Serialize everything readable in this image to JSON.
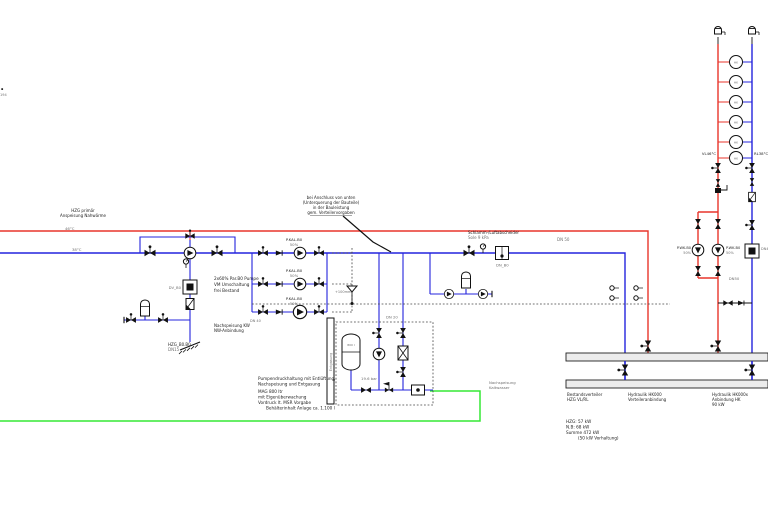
{
  "colors": {
    "supply_red": "#e8352b",
    "return_blue": "#2424dd",
    "fill_green": "#35e835",
    "line_black": "#111111",
    "header_fill": "#ececec",
    "text_gray": "#707070"
  },
  "labels": {
    "margin": {
      "l1": "▪",
      "l2": "194"
    },
    "feed": {
      "line1": "HZG primär",
      "line2": "Anspeisung Nahwärme",
      "vl": "46°C",
      "rl": "38°C"
    },
    "callout": {
      "l1": "bei Anschluss von unten",
      "l2": "(Unterquerung der Bauteile)",
      "l3": "in der Bauleistung",
      "l4": "gem. Verteilervorgaben"
    },
    "mixer": {
      "note1": "2x60% Par.B0 Pumpe",
      "note2": "VM Umschaltung",
      "note3": "frei Bestand",
      "dv": "DV_B0",
      "refill1": "Nachspeisung KW",
      "refill2": "NW-Anbindung",
      "tag1": "HZG_B0.B0",
      "tag2": "DN15"
    },
    "pumps": {
      "name": "P.KAL.B0",
      "pct": "50%"
    },
    "separator": {
      "l1": "Schlamm-/Luftabscheider",
      "l2": "Sole 9 kPa",
      "dn": "DN_B0"
    },
    "line": {
      "dn50": "DN 50",
      "plus": "+100mm",
      "dn40": "DN 40"
    },
    "unit": {
      "dn20": "DN 20",
      "vessel": "800 l",
      "bar": "19.6 bar",
      "column": "Entgasung",
      "n1": "Pumpendruckhaltung mit Entlüftung,",
      "n2": "Nachspeisung und Entgasung",
      "n3": "MAG 800 ltr",
      "n4": "mit Eigenüberwachung",
      "n5": "Vordruck lt. MSR Vorgabe",
      "n6": "Behälterinhalt Anlage ca. 1.100 l",
      "green1": "Nachspeisung",
      "green2": "Kaltwasser"
    },
    "headers": {
      "a1": "Bestandsverteiler",
      "a2": "HZG VL/RL",
      "b1": "Hydraulik HK000",
      "b2": "Verteileranbindung",
      "c1": "Hydraulik HK000x",
      "c2": "Anbindung HK",
      "c3": "90 kW",
      "s1": "HZG: 57 kW",
      "s2": "N.B: 68 kW",
      "s3": "Summe 472 kW",
      "s4": "(50 kW Vorhaltung)"
    },
    "riser": {
      "vl": "VL46°C",
      "rl": "RL38°C",
      "dn50": "DN50",
      "dn_right": "DN40",
      "pumpname": "P.WK.B0",
      "pct": "50%",
      "hk": "HK"
    }
  }
}
